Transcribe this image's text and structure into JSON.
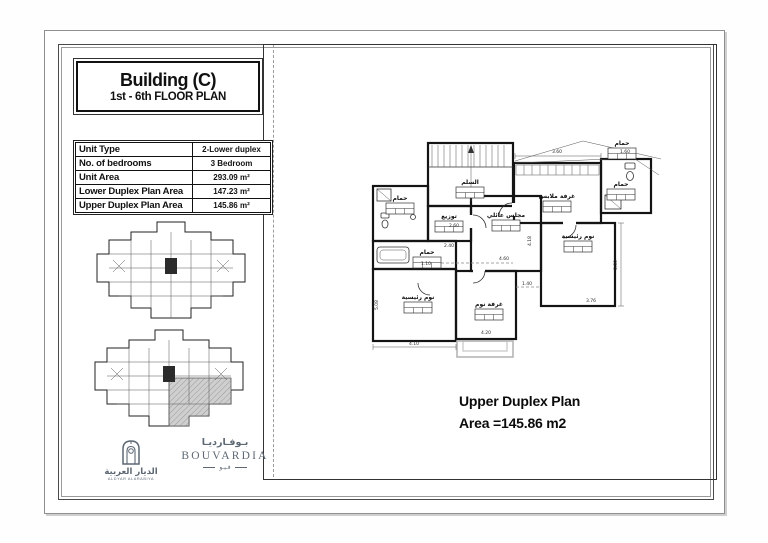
{
  "sheet": {
    "title_block": {
      "building": "Building (C)",
      "floor_plan": "1st - 6th FLOOR PLAN"
    },
    "spec_table": {
      "rows": [
        {
          "label": "Unit Type",
          "value": "2-Lower duplex"
        },
        {
          "label": "No. of bedrooms",
          "value": "3 Bedroom"
        },
        {
          "label": "Unit Area",
          "value": "293.09 m²"
        },
        {
          "label": "Lower Duplex Plan Area",
          "value": "147.23 m²"
        },
        {
          "label": "Upper Duplex Plan Area",
          "value": "145.86 m²"
        }
      ]
    },
    "caption": {
      "line1": "Upper Duplex Plan",
      "line2": "Area =145.86 m2"
    },
    "logos": {
      "aldyar": {
        "name_ar": "الديار العربية",
        "name_en": "ALDYAR ALARABIYA"
      },
      "bouvardia": {
        "name_ar": "بـوفـارديـا",
        "name_en": "BOUVARDIA",
        "sub_ar": "فـيـو"
      }
    },
    "colors": {
      "logo": "#5d6874",
      "wall": "#141414",
      "balcony": "#b5b5b5",
      "shaded_unit": "#cfcfcf"
    }
  },
  "plan": {
    "rooms": [
      {
        "label": "السلم"
      },
      {
        "label": "غرفة ملابس"
      },
      {
        "label": "حمام"
      },
      {
        "label": "حمام"
      },
      {
        "label": "حمام"
      },
      {
        "label": "توزيع"
      },
      {
        "label": "مجلس عائلي"
      },
      {
        "label": "نوم رئيسية"
      },
      {
        "label": "نوم رئيسية"
      },
      {
        "label": "غرفة نوم"
      }
    ],
    "leader_label": "حمام",
    "dims": [
      "3.60",
      "1.60",
      "2.60",
      "2.40",
      "4.60",
      "4.18",
      "1.40",
      "3.76",
      "5.50",
      "4.10",
      "4.20",
      "1.10",
      "5.08"
    ]
  }
}
